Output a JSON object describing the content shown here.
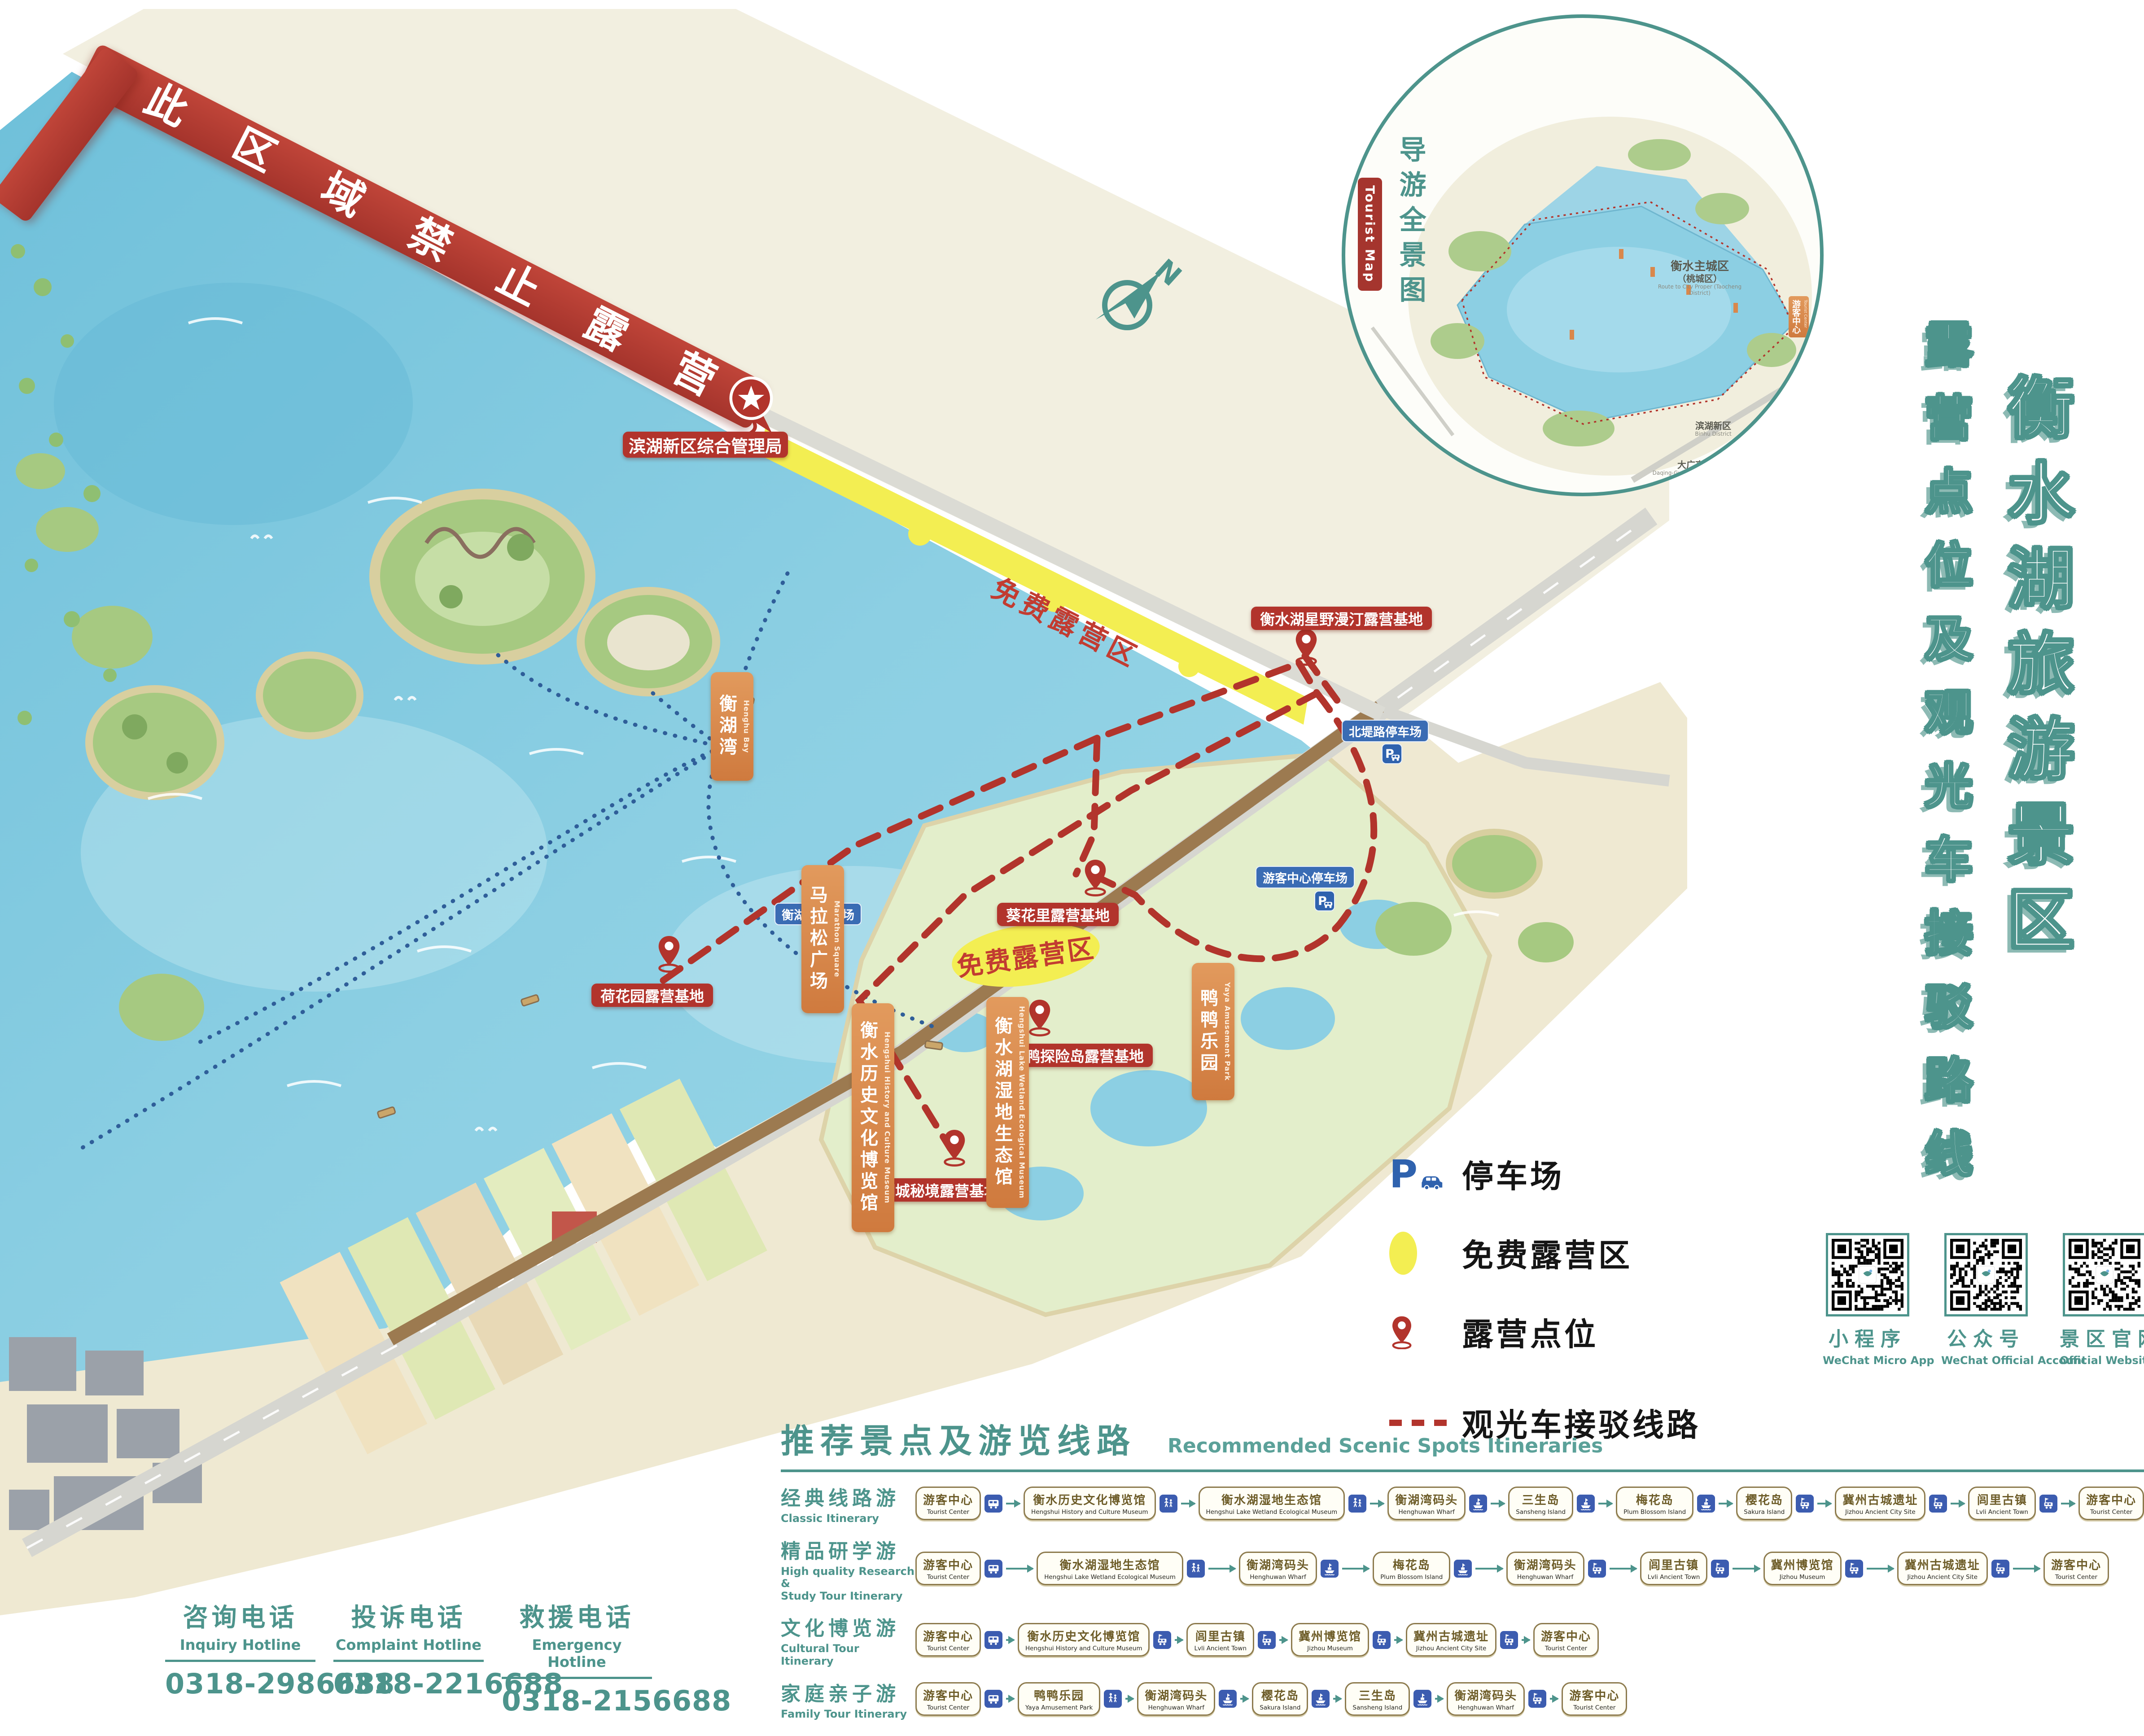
{
  "banner": {
    "text": "此区域禁止露营"
  },
  "admin": {
    "label": "滨湖新区综合管理局"
  },
  "compass": {
    "label": "N"
  },
  "titles": {
    "main": "衡水湖旅游景区",
    "sub": "露营点位及观光车接驳路线"
  },
  "inset": {
    "title": "导游全景图",
    "badge": "Tourist Map",
    "labels": [
      {
        "cn": "衡水主城区",
        "sub": "（桃城区）",
        "en": "Route to City Proper (Taocheng District)"
      },
      {
        "cn": "滨湖新区",
        "en": "Binhu District"
      },
      {
        "cn": "大广高速",
        "en": "Daqing-Guangzhou Expressway"
      },
      {
        "cn": "游客中心",
        "en": "Tourist Center"
      }
    ]
  },
  "map": {
    "free_strip_label": "免费露营区",
    "free_area_label": "免费露营区",
    "camp_sites": [
      {
        "label": "衡水湖星野漫汀露营基地"
      },
      {
        "label": "葵花里露营基地"
      },
      {
        "label": "鸭鸭探险岛露营基地"
      },
      {
        "label": "湖城秘境露营基地"
      },
      {
        "label": "荷花园露营基地"
      }
    ],
    "parkings": [
      {
        "label": "北堤路停车场"
      },
      {
        "label": "游客中心停车场"
      },
      {
        "label": "衡湖湾停车场"
      }
    ],
    "places": [
      {
        "cn": "衡湖湾",
        "en": "Henghu Bay"
      },
      {
        "cn": "马拉松广场",
        "en": "Marathon Square"
      },
      {
        "cn": "衡水历史文化博览馆",
        "en": "Hengshui History and Culture Museum"
      },
      {
        "cn": "衡水湖湿地生态馆",
        "en": "Hengshui Lake Wetland Ecological Museum"
      },
      {
        "cn": "鸭鸭乐园",
        "en": "Yaya Amusement Park"
      }
    ]
  },
  "legend": {
    "items": [
      {
        "icon": "parking-icon",
        "label": "停车场"
      },
      {
        "icon": "free-camp-zone-icon",
        "label": "免费露营区"
      },
      {
        "icon": "camp-pin-icon",
        "label": "露营点位"
      },
      {
        "icon": "shuttle-route-icon",
        "label": "观光车接驳线路"
      }
    ]
  },
  "qr_codes": [
    {
      "cn": "小程序",
      "en": "WeChat Micro App"
    },
    {
      "cn": "公众号",
      "en": "WeChat Official Account"
    },
    {
      "cn": "景区官网",
      "en": "Official Website"
    }
  ],
  "itinerary": {
    "title_cn": "推荐景点及游览线路",
    "title_en": "Recommended Scenic Spots Itineraries",
    "rows": [
      {
        "name_cn": "经典线路游",
        "name_en": "Classic Itinerary",
        "stops": [
          {
            "cn": "游客中心",
            "en": "Tourist Center"
          },
          {
            "cn": "衡水历史文化博览馆",
            "en": "Hengshui History and Culture Museum"
          },
          {
            "cn": "衡水湖湿地生态馆",
            "en": "Hengshui Lake Wetland Ecological Museum"
          },
          {
            "cn": "衡湖湾码头",
            "en": "Henghuwan Wharf"
          },
          {
            "cn": "三生岛",
            "en": "Sansheng Island"
          },
          {
            "cn": "梅花岛",
            "en": "Plum Blossom Island"
          },
          {
            "cn": "樱花岛",
            "en": "Sakura Island"
          },
          {
            "cn": "冀州古城遗址",
            "en": "Jizhou Ancient City Site"
          },
          {
            "cn": "闾里古镇",
            "en": "Lvli Ancient Town"
          },
          {
            "cn": "游客中心",
            "en": "Tourist Center"
          }
        ],
        "transports": [
          "bus",
          "walk",
          "walk",
          "boat",
          "boat",
          "boat",
          "cart",
          "cart",
          "cart"
        ]
      },
      {
        "name_cn": "精品研学游",
        "name_en": "High quality Research &\nStudy Tour Itinerary",
        "stops": [
          {
            "cn": "游客中心",
            "en": "Tourist Center"
          },
          {
            "cn": "衡水湖湿地生态馆",
            "en": "Hengshui Lake Wetland Ecological Museum"
          },
          {
            "cn": "衡湖湾码头",
            "en": "Henghuwan Wharf"
          },
          {
            "cn": "梅花岛",
            "en": "Plum Blossom Island"
          },
          {
            "cn": "衡湖湾码头",
            "en": "Henghuwan Wharf"
          },
          {
            "cn": "闾里古镇",
            "en": "Lvli Ancient Town"
          },
          {
            "cn": "冀州博览馆",
            "en": "Jizhou Museum"
          },
          {
            "cn": "冀州古城遗址",
            "en": "Jizhou Ancient City Site"
          },
          {
            "cn": "游客中心",
            "en": "Tourist Center"
          }
        ],
        "transports": [
          "bus",
          "walk",
          "boat",
          "boat",
          "cart",
          "cart",
          "cart",
          "cart"
        ]
      },
      {
        "name_cn": "文化博览游",
        "name_en": "Cultural Tour Itinerary",
        "stops": [
          {
            "cn": "游客中心",
            "en": "Tourist Center"
          },
          {
            "cn": "衡水历史文化博览馆",
            "en": "Hengshui History and Culture Museum"
          },
          {
            "cn": "闾里古镇",
            "en": "Lvli Ancient Town"
          },
          {
            "cn": "冀州博览馆",
            "en": "Jizhou Museum"
          },
          {
            "cn": "冀州古城遗址",
            "en": "Jizhou Ancient City Site"
          },
          {
            "cn": "游客中心",
            "en": "Tourist Center"
          }
        ],
        "transports": [
          "bus",
          "cart",
          "cart",
          "cart",
          "cart"
        ]
      },
      {
        "name_cn": "家庭亲子游",
        "name_en": "Family Tour Itinerary",
        "stops": [
          {
            "cn": "游客中心",
            "en": "Tourist Center"
          },
          {
            "cn": "鸭鸭乐园",
            "en": "Yaya Amusement Park"
          },
          {
            "cn": "衡湖湾码头",
            "en": "Henghuwan Wharf"
          },
          {
            "cn": "樱花岛",
            "en": "Sakura Island"
          },
          {
            "cn": "三生岛",
            "en": "Sansheng Island"
          },
          {
            "cn": "衡湖湾码头",
            "en": "Henghuwan Wharf"
          },
          {
            "cn": "游客中心",
            "en": "Tourist Center"
          }
        ],
        "transports": [
          "bus",
          "walk",
          "boat",
          "boat",
          "boat",
          "cart"
        ]
      }
    ]
  },
  "hotlines": [
    {
      "cn": "咨询电话",
      "en": "Inquiry Hotline",
      "number": "0318-2986688"
    },
    {
      "cn": "投诉电话",
      "en": "Complaint Hotline",
      "number": "0318-2216688"
    },
    {
      "cn": "救援电话",
      "en": "Emergency Hotline",
      "number": "0318-2156688"
    }
  ],
  "colors": {
    "accent": "#4d948c",
    "banner_red": "#a5342c",
    "label_red": "#b2342c",
    "orange": "#d9874b",
    "parking_blue": "#2f62ae",
    "icon_blue": "#3c5cb0",
    "free_yellow": "#f3ee52"
  }
}
